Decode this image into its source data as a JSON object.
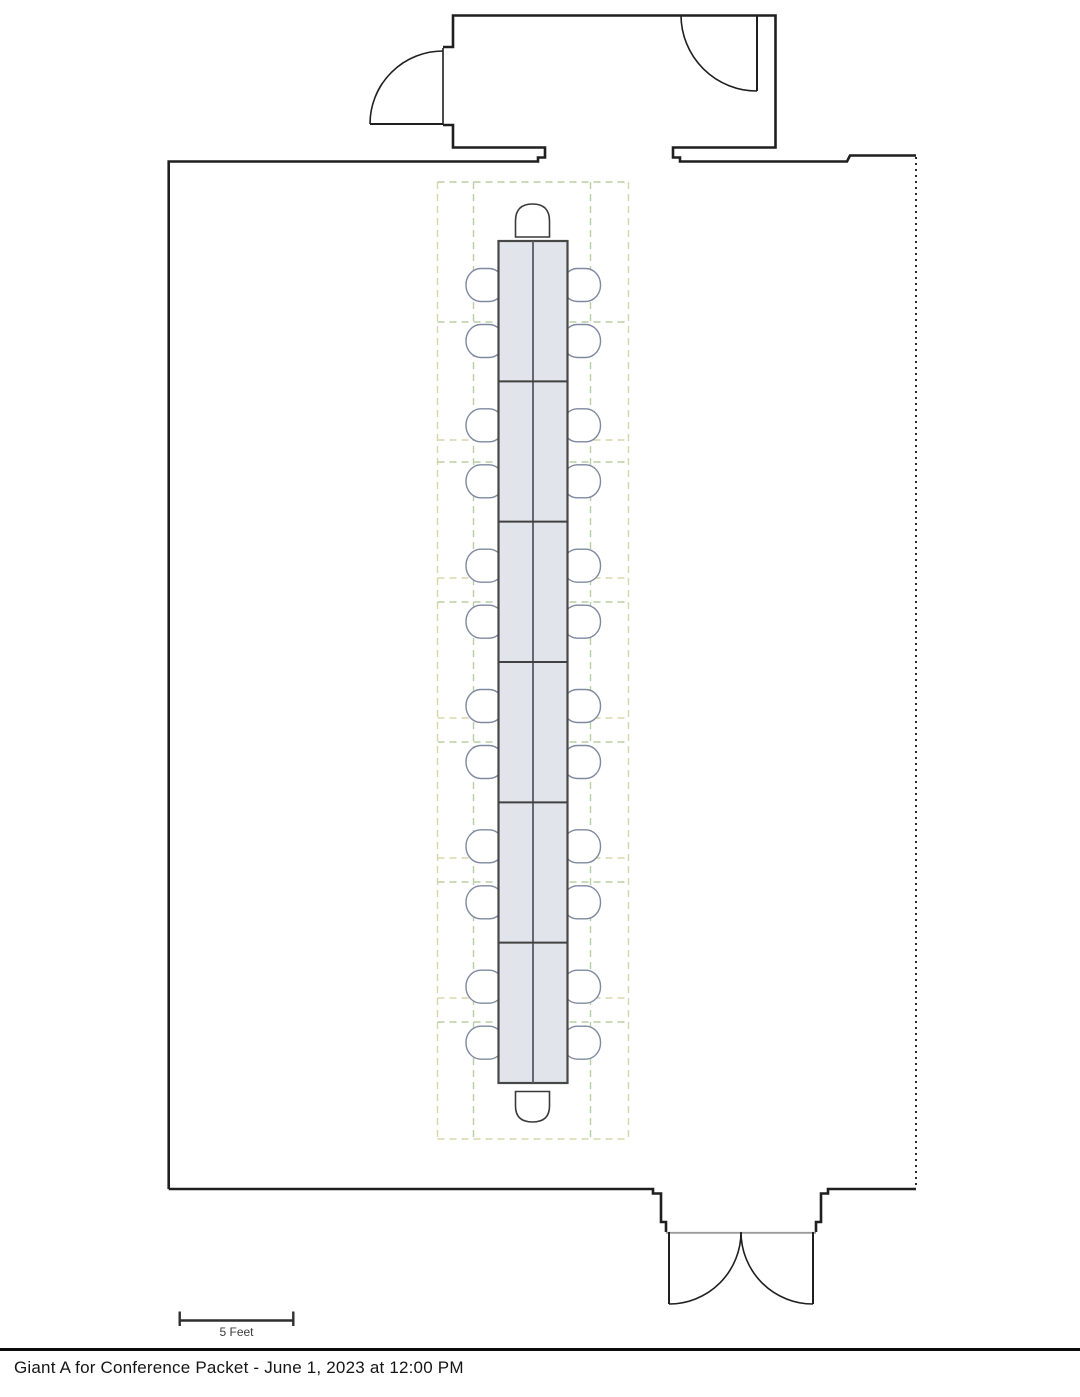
{
  "page": {
    "caption": "Giant A for Conference Packet - June 1, 2023 at 12:00 PM",
    "background": "#ffffff"
  },
  "scale_bar": {
    "label": "5 Feet"
  },
  "floor_plan": {
    "room": {
      "wall_color": "#1f1f1f"
    },
    "table": {
      "segments": 6,
      "fill": "#e1e5eb",
      "border_color": "#474747",
      "divider_color": "#414141",
      "center_line_color": "#565b63"
    },
    "seating": {
      "side_chairs_per_side": 12,
      "end_chairs": 2,
      "total_chairs": 26,
      "side_chair_outline": "#7e88a0",
      "end_chair_outline": "#3a3a3a",
      "chair_fill": "#ffffff"
    },
    "guides": {
      "green": "#b8cfa4",
      "tan": "#d8d6a8"
    },
    "doors": {
      "threshold_color": "#9b9b9b"
    }
  }
}
